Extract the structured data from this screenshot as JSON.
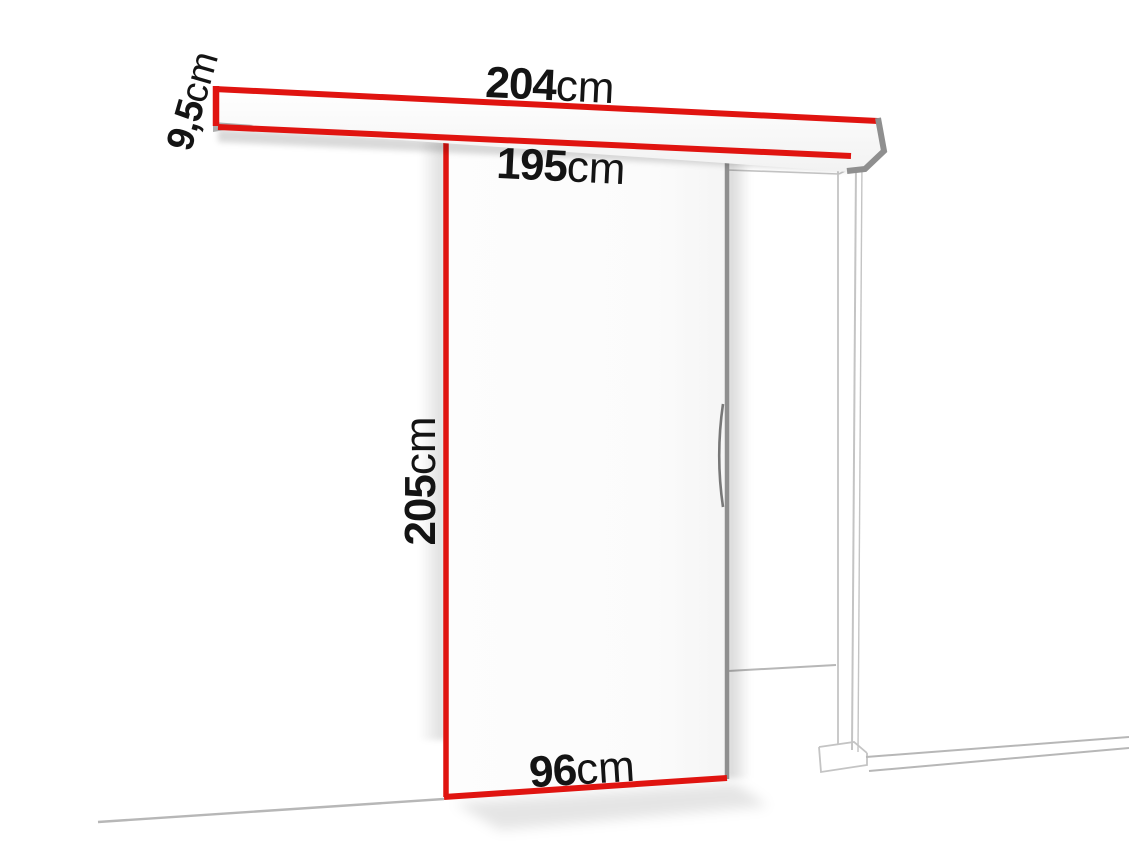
{
  "diagram": {
    "kind": "sliding-door-dimension-diagram",
    "dimensions": {
      "rail_length": {
        "value": "204",
        "unit": "cm"
      },
      "clear_width": {
        "value": "195",
        "unit": "cm"
      },
      "rail_height": {
        "value": "9,5",
        "unit": "cm"
      },
      "door_height": {
        "value": "205",
        "unit": "cm"
      },
      "door_width": {
        "value": "96",
        "unit": "cm"
      }
    }
  },
  "colors": {
    "accent_red": "#e01410",
    "line_gray": "#b7b7b7",
    "frame_gray": "#c4c4c4",
    "edge_gray": "#8f8f8f",
    "text": "#141414",
    "background": "#ffffff"
  }
}
